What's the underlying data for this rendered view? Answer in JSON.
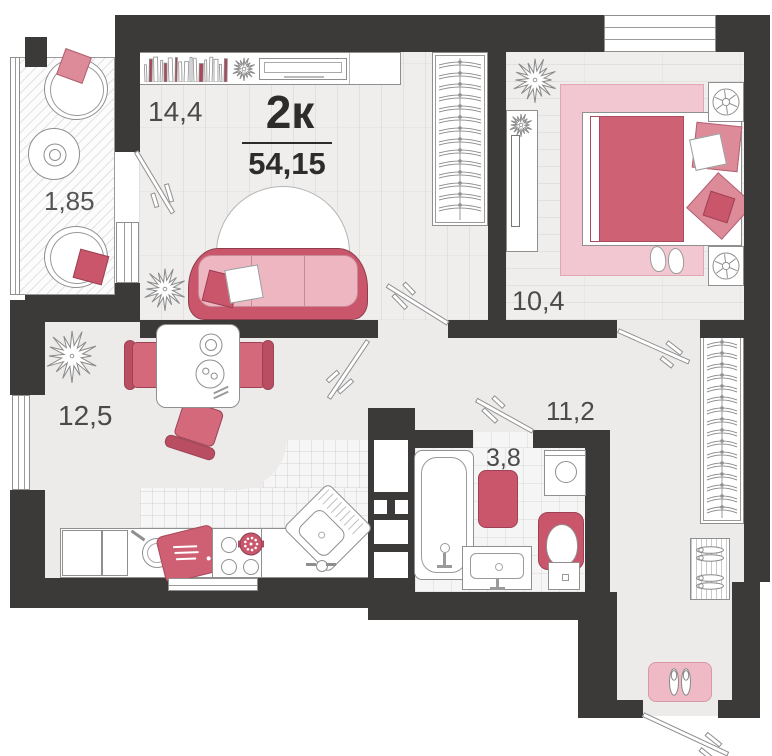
{
  "plan": {
    "type_label": "2к",
    "total_area": "54,15",
    "rooms": {
      "living": {
        "area": "14,4"
      },
      "balcony": {
        "area": "1,85"
      },
      "bedroom": {
        "area": "10,4"
      },
      "kitchen": {
        "area": "12,5"
      },
      "hallway": {
        "area": "11,2"
      },
      "bathroom": {
        "area": "3,8"
      }
    },
    "colors": {
      "wall": "#3b3a39",
      "floor_light": "#efeeed",
      "floor_plain": "#ecebea",
      "accent_dark": "#c9566b",
      "accent_mid": "#dd8a99",
      "accent_light": "#f0bec9",
      "rug_pink": "#f3c7d1",
      "outline_gray": "#8f8f8f",
      "text_gray": "#4a4a4a"
    }
  }
}
